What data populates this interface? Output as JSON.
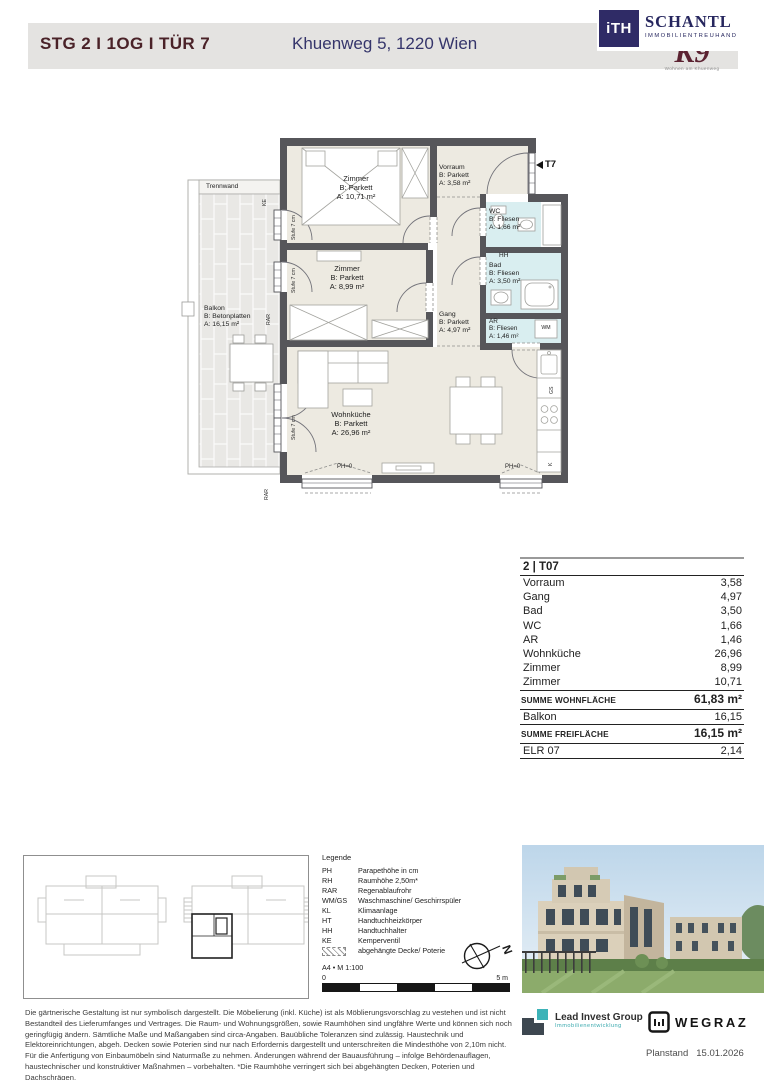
{
  "header": {
    "title": "STG 2 I 1OG I TÜR 7",
    "address": "Khuenweg 5, 1220 Wien"
  },
  "branding": {
    "ith": "iTH",
    "name": "SCHANTL",
    "name_sub": "IMMOBILIENTREUHAND",
    "k9": "K9",
    "k9_sub": "Wohnen am Khuenweg"
  },
  "colors": {
    "title_maroon": "#4a2228",
    "brand_navy": "#2f2b66",
    "wall_gray": "#56565a",
    "room_beige": "#edeae1",
    "bath_cyan": "#d9eef0",
    "accent_teal": "#3aa9ae"
  },
  "plan": {
    "rooms": [
      {
        "name": "Zimmer",
        "surface": "B: Parkett",
        "area": "A: 10,71 m²"
      },
      {
        "name": "Zimmer",
        "surface": "B: Parkett",
        "area": "A: 8,99 m²"
      },
      {
        "name": "Vorraum",
        "surface": "B: Parkett",
        "area": "A: 3,58 m²"
      },
      {
        "name": "Gang",
        "surface": "B: Parkett",
        "area": "A: 4,97 m²"
      },
      {
        "name": "WC",
        "surface": "B: Fliesen",
        "area": "A: 1,66 m²"
      },
      {
        "name": "Bad",
        "surface": "B: Fliesen",
        "area": "A: 3,50 m²"
      },
      {
        "name": "AR",
        "surface": "B: Fliesen",
        "area": "A: 1,46 m²"
      },
      {
        "name": "Wohnküche",
        "surface": "B: Parkett",
        "area": "A: 26,96 m²"
      },
      {
        "name": "Balkon",
        "surface": "B: Betonplatten",
        "area": "A: 16,15 m²"
      }
    ],
    "annotations": {
      "trennwand": "Trennwand",
      "ke": "KE",
      "rar": "RAR",
      "stufe": "Stufe 7 cm",
      "ph0": "PH=0",
      "t7": "T7",
      "wm": "WM",
      "hh": "HH",
      "gs": "GS",
      "k": "K"
    }
  },
  "area_table": {
    "unit": "2 | T07",
    "rows": [
      {
        "label": "Vorraum",
        "value": "3,58"
      },
      {
        "label": "Gang",
        "value": "4,97"
      },
      {
        "label": "Bad",
        "value": "3,50"
      },
      {
        "label": "WC",
        "value": "1,66"
      },
      {
        "label": "AR",
        "value": "1,46"
      },
      {
        "label": "Wohnküche",
        "value": "26,96"
      },
      {
        "label": "Zimmer",
        "value": "8,99"
      },
      {
        "label": "Zimmer",
        "value": "10,71"
      }
    ],
    "sum_living": {
      "label": "SUMME WOHNFLÄCHE",
      "value": "61,83 m²"
    },
    "balcony_row": {
      "label": "Balkon",
      "value": "16,15"
    },
    "sum_free": {
      "label": "SUMME FREIFLÄCHE",
      "value": "16,15 m²"
    },
    "elr_row": {
      "label": "ELR 07",
      "value": "2,14"
    }
  },
  "legend": {
    "title": "Legende",
    "items": [
      {
        "abbr": "PH",
        "desc": "Parapethöhe in cm"
      },
      {
        "abbr": "RH",
        "desc": "Raumhöhe  2,50m*"
      },
      {
        "abbr": "RAR",
        "desc": "Regenablaufrohr"
      },
      {
        "abbr": "WM/GS",
        "desc": "Waschmaschine/ Geschirrspüler"
      },
      {
        "abbr": "KL",
        "desc": "Klimaanlage"
      },
      {
        "abbr": "HT",
        "desc": "Handtuchheizkörper"
      },
      {
        "abbr": "HH",
        "desc": "Handtuchhalter"
      },
      {
        "abbr": "KE",
        "desc": "Kemperventil"
      },
      {
        "abbr": "",
        "desc": "abgehängte Decke/ Poterie"
      }
    ],
    "format": "A4 • M 1:100",
    "scale_zero": "0",
    "scale_max": "5 m",
    "compass": "N"
  },
  "disclaimer": "Die gärtnerische Gestaltung ist nur symbolisch dargestellt. Die Möbelierung (inkl. Küche) ist als Möblierungsvorschlag zu vestehen und ist nicht Bestandteil des Lieferumfanges und Vertrages. Die Raum- und Wohnungsgrößen, sowie Raumhöhen sind ungfähre Werte und können sich noch geringfügig ändern. Sämtliche Maße und Maßangaben sind circa-Angaben. Bauübliche Toleranzen sind zulässig. Haustechnik und Elektoreinrichtungen, abgeh. Decken sowie Poterien sind nur nach Erfordernis dargestellt und unterschreiten die Mindesthöhe von 2,10m nicht. Für die Anfertigung von Einbaumöbeln sind Naturmaße zu nehmen. Änderungen während der Bauausführung – infolge Behördenauflagen, haustechnischer und konstruktiver Maßnahmen – vorbehalten.   *Die Raumhöhe verringert sich bei abgehängten Decken, Poterien und Dachschrägen.",
  "footer": {
    "lead_invest_name": "Lead Invest Group",
    "lead_invest_sub": "Immobilienentwicklung",
    "wegraz": "WEGRAZ",
    "planstand_label": "Planstand",
    "planstand_date": "15.01.2026"
  }
}
